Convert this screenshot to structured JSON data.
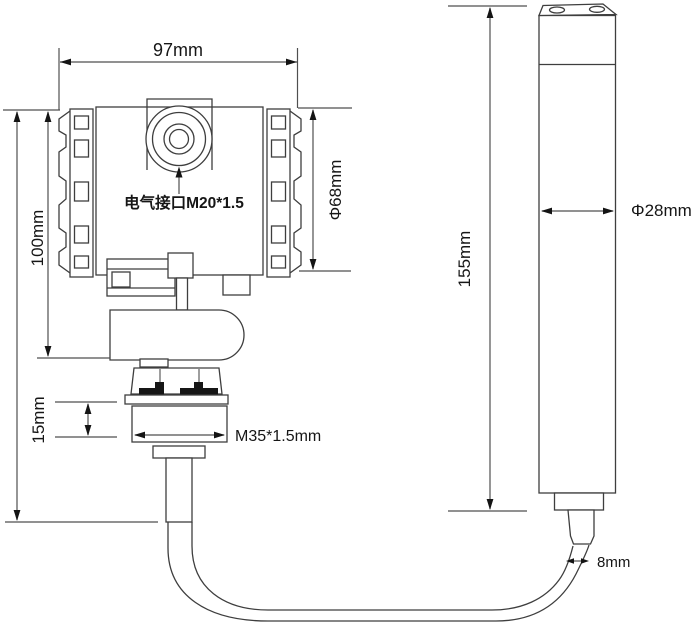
{
  "labels": {
    "top_width": "97mm",
    "body_height": "100mm",
    "thread_length": "15mm",
    "head_diameter": "Φ68mm",
    "electrical_interface": "电气接口M20*1.5",
    "process_thread": "M35*1.5mm",
    "probe_length": "155mm",
    "probe_diameter": "Φ28mm",
    "cable_diameter": "8mm"
  },
  "colors": {
    "background": "#ffffff",
    "object_line": "#3e3e3e",
    "dimension_line": "#4f4f4f",
    "text": "#161616",
    "gasket_fill": "#161616"
  }
}
